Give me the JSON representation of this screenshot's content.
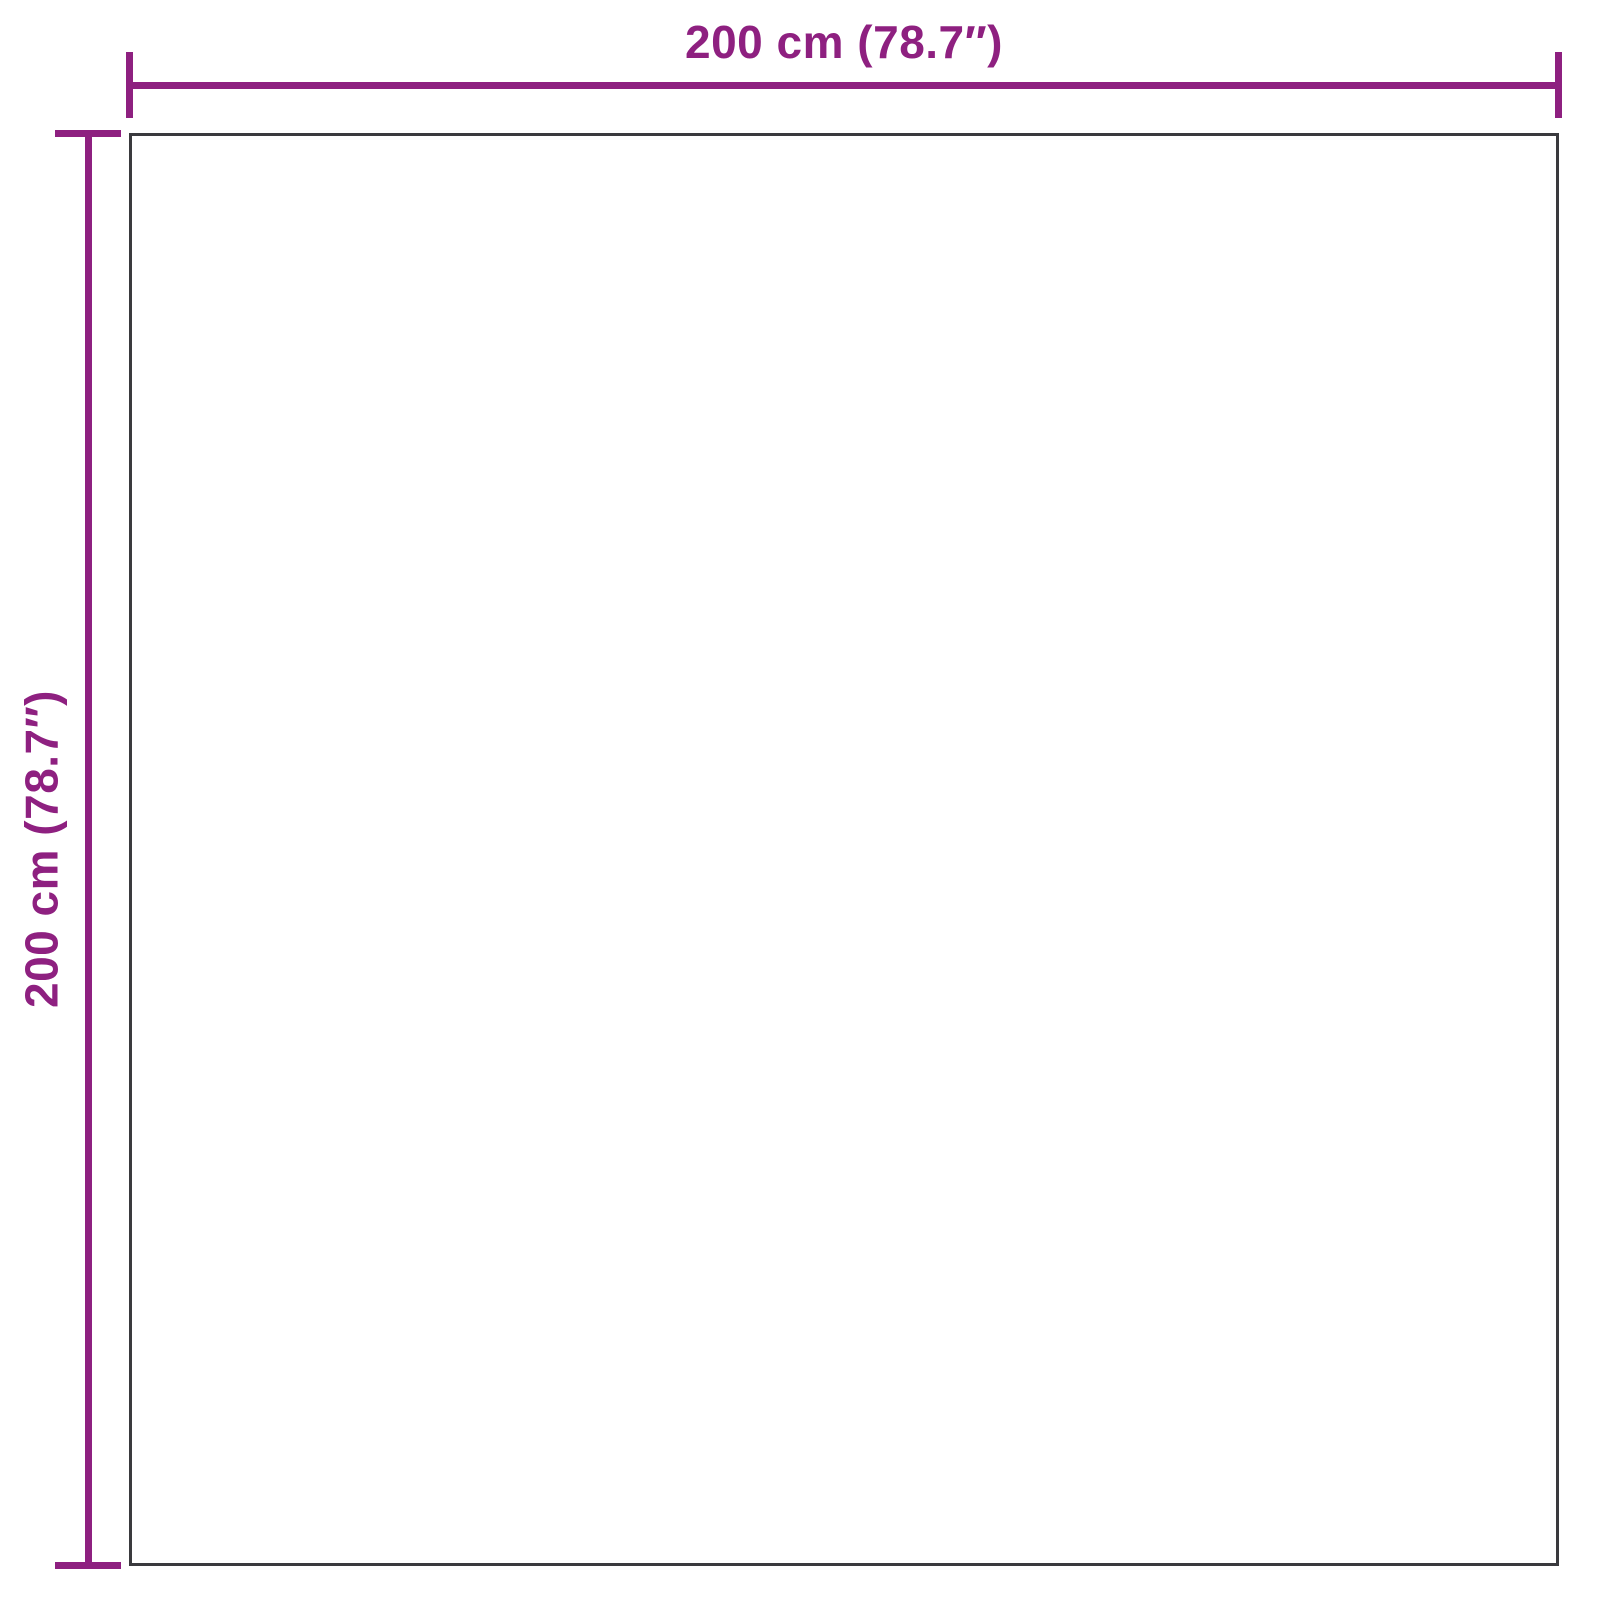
{
  "diagram": {
    "type": "product-dimension-diagram",
    "width_label": "200 cm (78.7″)",
    "height_label": "200 cm (78.7″)",
    "width_value_cm": 200,
    "height_value_cm": 200,
    "width_value_inch": 78.7,
    "height_value_inch": 78.7,
    "accent_color": "#8E2080",
    "outline_color": "#3A3A3E",
    "background_color": "#FFFFFF"
  }
}
